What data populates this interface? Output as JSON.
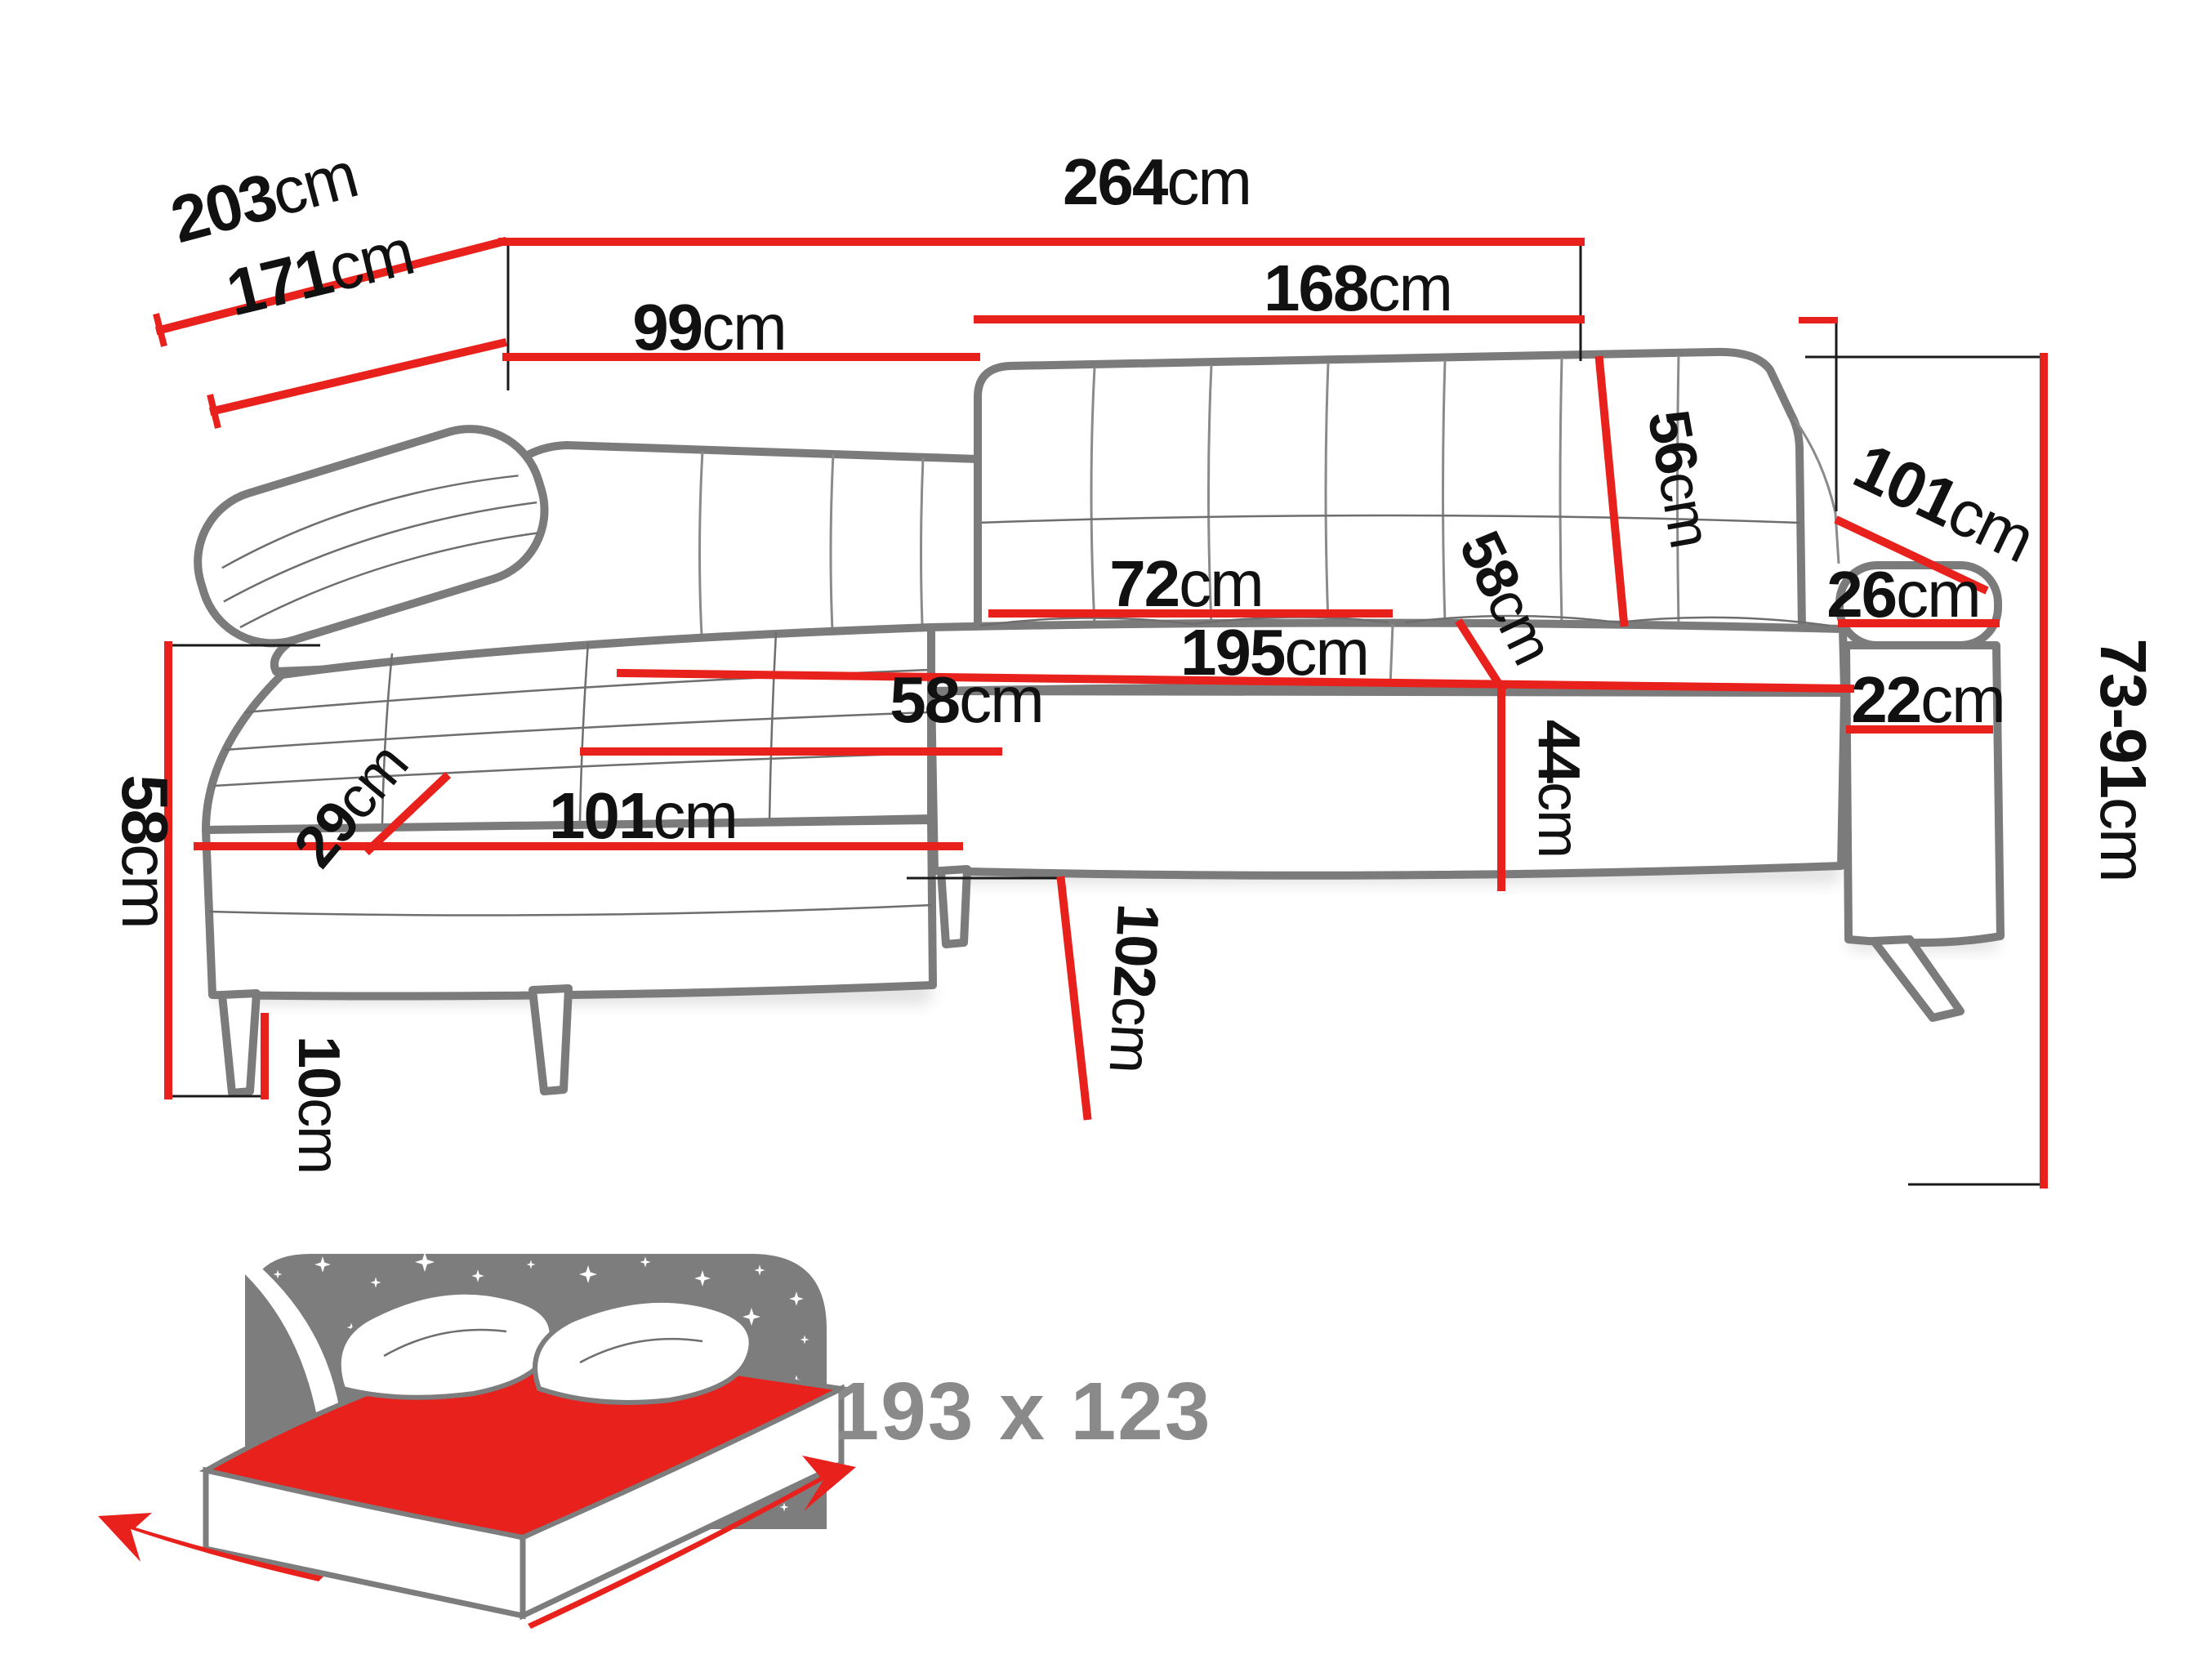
{
  "diagram": {
    "type": "corner-sofa-dimension-drawing",
    "unit": "cm",
    "colors": {
      "dimension_line": "#e8211d",
      "label_text": "#111111",
      "sofa_outline": "#7b7b7b",
      "bed_icon_gray": "#7d7d7d",
      "bed_label_gray": "#8a8a8a",
      "mattress_red": "#e8211d"
    }
  },
  "m": {
    "d264": {
      "v": "264",
      "u": "cm"
    },
    "d203": {
      "v": "203",
      "u": "cm"
    },
    "d171": {
      "v": "171",
      "u": "cm"
    },
    "d99": {
      "v": "99",
      "u": "cm"
    },
    "d168": {
      "v": "168",
      "u": "cm"
    },
    "d56": {
      "v": "56",
      "u": "cm"
    },
    "d101r": {
      "v": "101",
      "u": "cm"
    },
    "d26": {
      "v": "26",
      "u": "cm"
    },
    "d7391": {
      "v": "73-91",
      "u": "cm"
    },
    "d72": {
      "v": "72",
      "u": "cm"
    },
    "d58d": {
      "v": "58",
      "u": "cm"
    },
    "d195": {
      "v": "195",
      "u": "cm"
    },
    "d22": {
      "v": "22",
      "u": "cm"
    },
    "d44": {
      "v": "44",
      "u": "cm"
    },
    "d58h": {
      "v": "58",
      "u": "cm"
    },
    "d29": {
      "v": "29",
      "u": "cm"
    },
    "d101l": {
      "v": "101",
      "u": "cm"
    },
    "d58l": {
      "v": "58",
      "u": "cm"
    },
    "d10": {
      "v": "10",
      "u": "cm"
    },
    "d102": {
      "v": "102",
      "u": "cm"
    }
  },
  "bed": {
    "sleeping_area": "193 x 123"
  }
}
